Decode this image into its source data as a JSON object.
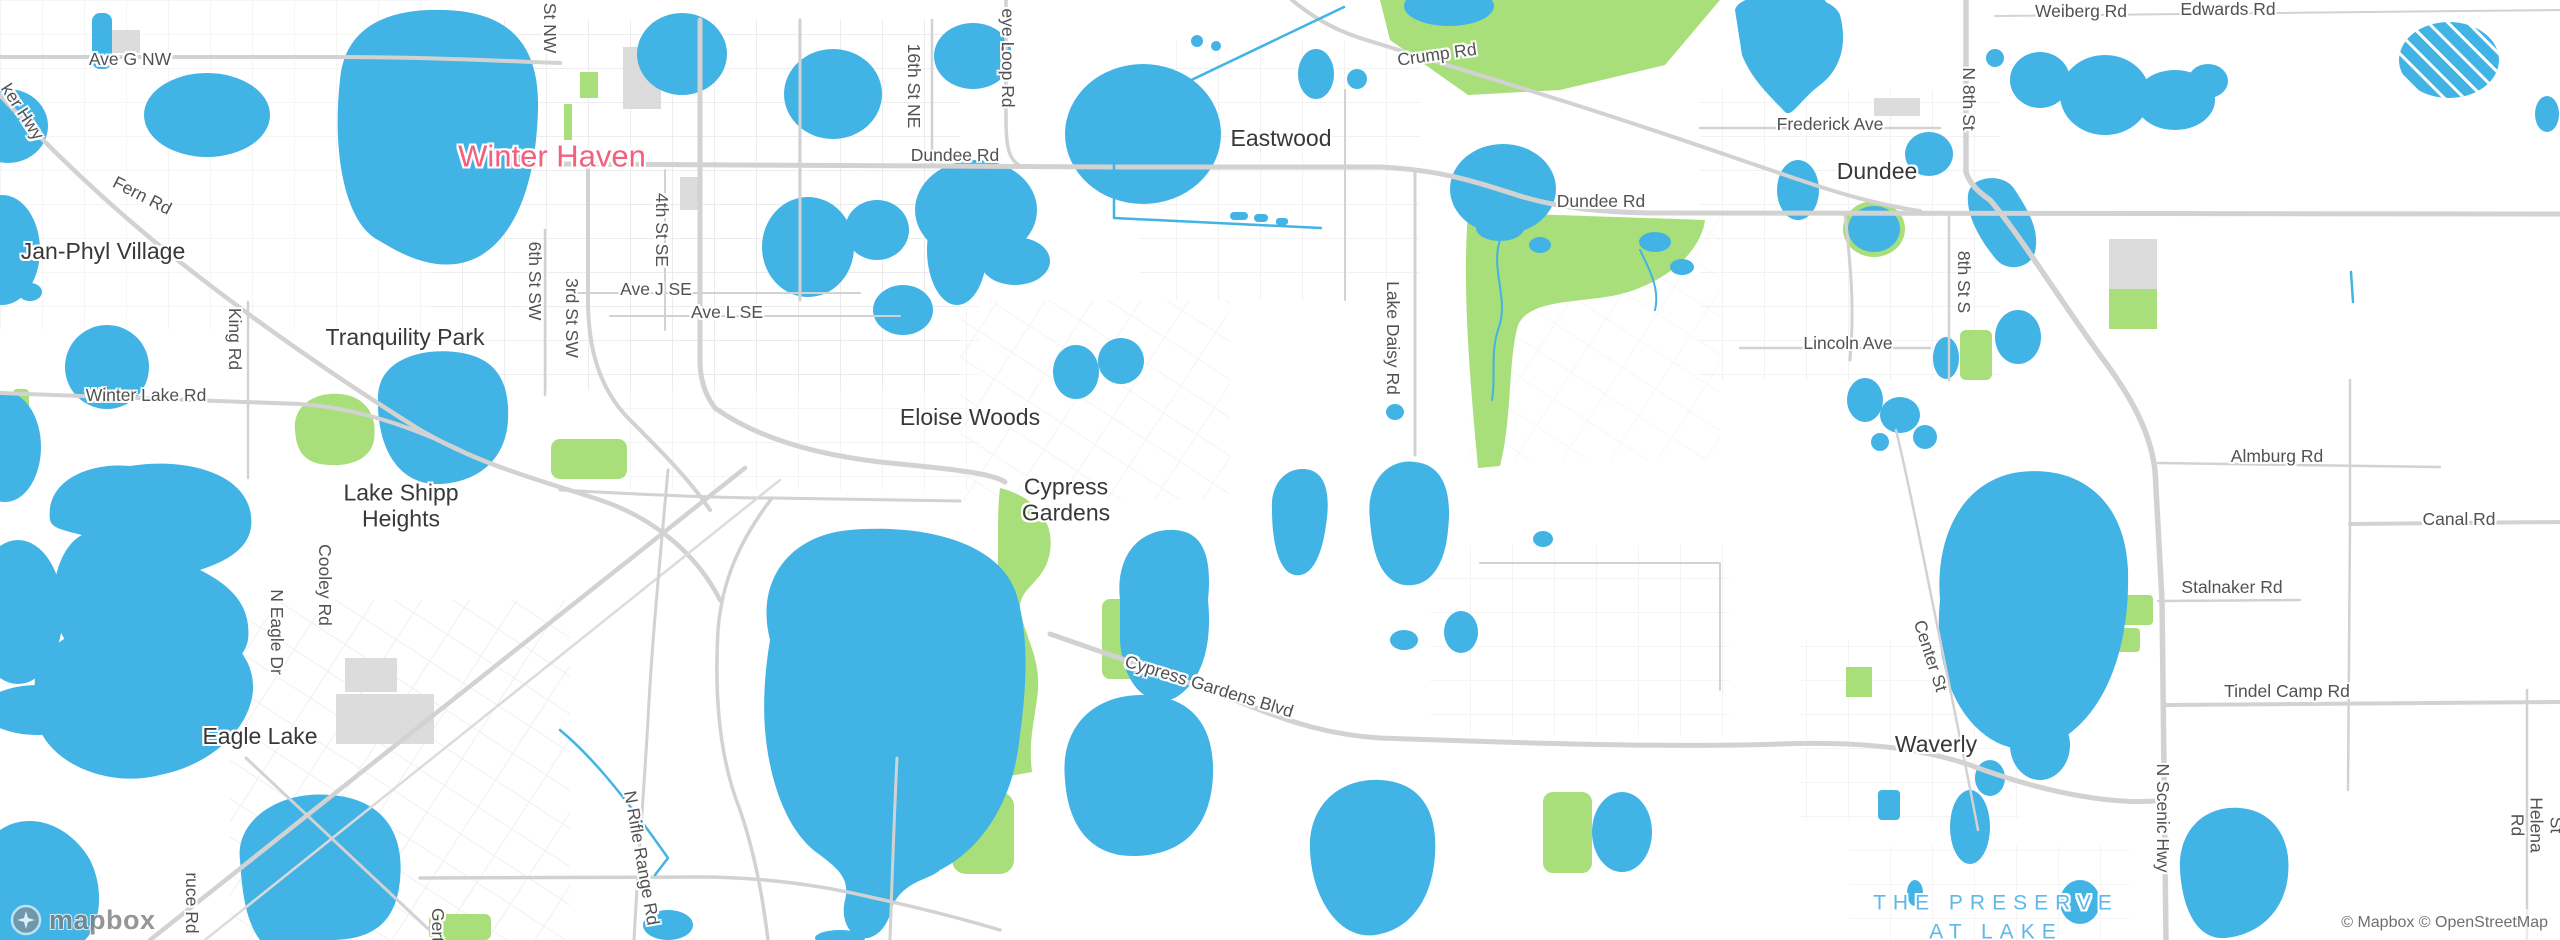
{
  "map": {
    "attribution": "© Mapbox © OpenStreetMap",
    "logo_text": "mapbox",
    "colors": {
      "water": "#42b3e5",
      "park": "#a9df7a",
      "builtup": "#dcdcdc",
      "road": "#d2d2d2",
      "road-med": "#dbdbdb",
      "minor": "#e9e9e9",
      "land": "#ffffff",
      "town": "#f2607d",
      "preserve": "#5fb8e8",
      "citytext": "#383838",
      "roadtext": "#525252"
    },
    "labels": [
      {
        "name": "label-winter-haven",
        "cls": "town-major",
        "x": 552,
        "y": 157,
        "text": "Winter Haven"
      },
      {
        "name": "label-jan-phyl-village",
        "cls": "city",
        "x": 103,
        "y": 252,
        "text": "Jan-Phyl Village"
      },
      {
        "name": "label-tranquility-park",
        "cls": "city",
        "x": 405,
        "y": 338,
        "text": "Tranquility Park"
      },
      {
        "name": "label-lake-shipp-heights",
        "cls": "city",
        "x": 401,
        "y": 506,
        "text": "Lake Shipp\nHeights"
      },
      {
        "name": "label-eagle-lake",
        "cls": "city",
        "x": 260,
        "y": 737,
        "text": "Eagle Lake"
      },
      {
        "name": "label-eloise-woods",
        "cls": "city",
        "x": 970,
        "y": 418,
        "text": "Eloise Woods"
      },
      {
        "name": "label-cypress-gardens",
        "cls": "city",
        "x": 1066,
        "y": 500,
        "text": "Cypress\nGardens"
      },
      {
        "name": "label-eastwood",
        "cls": "city",
        "x": 1281,
        "y": 139,
        "text": "Eastwood"
      },
      {
        "name": "label-dundee",
        "cls": "city",
        "x": 1877,
        "y": 172,
        "text": "Dundee"
      },
      {
        "name": "label-waverly",
        "cls": "city",
        "x": 1936,
        "y": 745,
        "text": "Waverly"
      },
      {
        "name": "label-ave-g-nw",
        "cls": "road",
        "x": 130,
        "y": 60,
        "text": "Ave G NW"
      },
      {
        "name": "label-ker-hwy",
        "cls": "road",
        "x": 22,
        "y": 112,
        "rot": 57,
        "text": "ker Hwy"
      },
      {
        "name": "label-fern-rd",
        "cls": "road",
        "x": 142,
        "y": 196,
        "rot": 27,
        "text": "Fern Rd"
      },
      {
        "name": "label-winter-lake-rd",
        "cls": "road",
        "x": 146,
        "y": 396,
        "text": "Winter Lake Rd"
      },
      {
        "name": "label-king-rd",
        "cls": "road",
        "x": 234,
        "y": 339,
        "rot": 90,
        "text": "King Rd"
      },
      {
        "name": "label-cooley-rd",
        "cls": "road",
        "x": 324,
        "y": 585,
        "rot": 90,
        "text": "Cooley Rd"
      },
      {
        "name": "label-n-eagle-dr",
        "cls": "road",
        "x": 276,
        "y": 632,
        "rot": 90,
        "text": "N Eagle Dr"
      },
      {
        "name": "label-ruce-rd",
        "cls": "road",
        "x": 191,
        "y": 903,
        "rot": 90,
        "text": "ruce Rd"
      },
      {
        "name": "label-gert-rd",
        "cls": "road",
        "x": 437,
        "y": 925,
        "rot": 90,
        "text": "Gert"
      },
      {
        "name": "label-n-rifle-range-rd",
        "cls": "road",
        "x": 641,
        "y": 858,
        "rot": 80,
        "text": "N Rifle Range Rd"
      },
      {
        "name": "label-6th-st-sw",
        "cls": "road",
        "x": 534,
        "y": 281,
        "rot": 90,
        "text": "6th St SW"
      },
      {
        "name": "label-3rd-st-sw",
        "cls": "road",
        "x": 571,
        "y": 318,
        "rot": 90,
        "text": "3rd St SW"
      },
      {
        "name": "label-st-nw",
        "cls": "road",
        "x": 549,
        "y": 28,
        "rot": 90,
        "text": "St NW"
      },
      {
        "name": "label-4th-st-se",
        "cls": "road",
        "x": 661,
        "y": 230,
        "rot": 90,
        "text": "4th St SE"
      },
      {
        "name": "label-ave-j-se",
        "cls": "road",
        "x": 656,
        "y": 290,
        "text": "Ave J SE"
      },
      {
        "name": "label-ave-l-se",
        "cls": "road",
        "x": 727,
        "y": 313,
        "text": "Ave L SE"
      },
      {
        "name": "label-16th-st-ne",
        "cls": "road",
        "x": 913,
        "y": 86,
        "rot": 90,
        "text": "16th St NE"
      },
      {
        "name": "label-eye-loop-rd",
        "cls": "road",
        "x": 1007,
        "y": 58,
        "rot": 90,
        "text": "eye Loop Rd"
      },
      {
        "name": "label-dundee-rd-w",
        "cls": "road",
        "x": 955,
        "y": 156,
        "text": "Dundee Rd"
      },
      {
        "name": "label-crump-rd",
        "cls": "road",
        "x": 1437,
        "y": 55,
        "rot": -8,
        "text": "Crump Rd"
      },
      {
        "name": "label-dundee-rd-e",
        "cls": "road",
        "x": 1601,
        "y": 202,
        "text": "Dundee Rd"
      },
      {
        "name": "label-lake-daisy-rd",
        "cls": "road",
        "x": 1392,
        "y": 338,
        "rot": 90,
        "text": "Lake Daisy Rd"
      },
      {
        "name": "label-cypress-gardens-blvd",
        "cls": "road",
        "x": 1209,
        "y": 687,
        "rot": 17,
        "text": "Cypress Gardens Blvd"
      },
      {
        "name": "label-frederick-ave",
        "cls": "road",
        "x": 1830,
        "y": 125,
        "text": "Frederick Ave"
      },
      {
        "name": "label-n-8th-st",
        "cls": "road",
        "x": 1968,
        "y": 99,
        "rot": 90,
        "text": "N 8th St"
      },
      {
        "name": "label-8th-st-s",
        "cls": "road",
        "x": 1963,
        "y": 282,
        "rot": 90,
        "text": "8th St S"
      },
      {
        "name": "label-lincoln-ave",
        "cls": "road",
        "x": 1848,
        "y": 344,
        "text": "Lincoln Ave"
      },
      {
        "name": "label-weiberg-rd",
        "cls": "road",
        "x": 2081,
        "y": 12,
        "text": "Weiberg Rd"
      },
      {
        "name": "label-edwards-rd",
        "cls": "road",
        "x": 2228,
        "y": 10,
        "text": "Edwards Rd"
      },
      {
        "name": "label-almburg-rd",
        "cls": "road",
        "x": 2277,
        "y": 457,
        "text": "Almburg Rd"
      },
      {
        "name": "label-canal-rd",
        "cls": "road",
        "x": 2459,
        "y": 520,
        "text": "Canal Rd"
      },
      {
        "name": "label-stalnaker-rd",
        "cls": "road",
        "x": 2232,
        "y": 588,
        "text": "Stalnaker Rd"
      },
      {
        "name": "label-center-st",
        "cls": "road",
        "x": 1930,
        "y": 656,
        "rot": 72,
        "text": "Center St"
      },
      {
        "name": "label-tindel-camp-rd",
        "cls": "road",
        "x": 2287,
        "y": 692,
        "text": "Tindel Camp Rd"
      },
      {
        "name": "label-n-scenic-hwy",
        "cls": "road",
        "x": 2162,
        "y": 818,
        "rot": 90,
        "text": "N Scenic Hwy"
      },
      {
        "name": "label-st-helena-rd",
        "cls": "road",
        "x": 2536,
        "y": 825,
        "rot": 90,
        "text": "St Helena Rd"
      },
      {
        "name": "label-the-preserve-at-lake",
        "cls": "preserve",
        "x": 1996,
        "y": 918,
        "text": "THE PRESERVE\nAT LAKE"
      }
    ]
  }
}
